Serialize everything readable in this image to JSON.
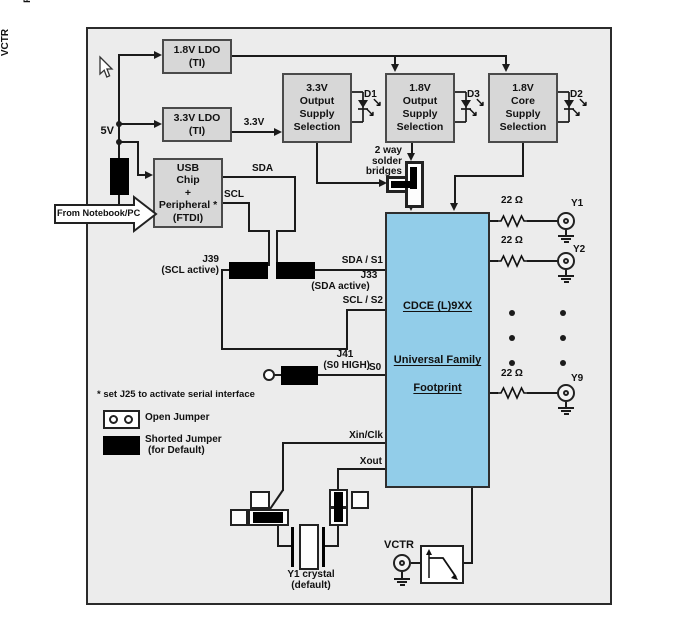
{
  "colors": {
    "ln": "#1b1b1b",
    "panel": "#ececec",
    "bf": "#d7d7d7",
    "bb": "#4a4a4a",
    "chip": "#92cde9"
  },
  "icons": {
    "led_arrow": "↘"
  },
  "power": {
    "v5": "5V",
    "ldo18": {
      "l1": "1.8V LDO",
      "l2": "(TI)"
    },
    "ldo33": {
      "l1": "3.3V LDO",
      "l2": "(TI)"
    },
    "rail33": "3.3V",
    "sel33": {
      "l1": "3.3V",
      "l2": "Output",
      "l3": "Supply",
      "l4": "Selection"
    },
    "sel18out": {
      "l1": "1.8V",
      "l2": "Output",
      "l3": "Supply",
      "l4": "Selection"
    },
    "sel18core": {
      "l1": "1.8V",
      "l2": "Core",
      "l3": "Supply",
      "l4": "Selection"
    },
    "d1": "D1",
    "d3": "D3",
    "d2": "D2",
    "bridge": {
      "l1": "2 way",
      "l2": "solder",
      "l3": "bridges"
    }
  },
  "usb": {
    "from_pc": "From Notebook/PC",
    "j23": {
      "l1": "J23",
      "l2": "(USB Power)"
    },
    "chip": {
      "l1": "USB",
      "l2": "Chip",
      "l3": "+",
      "l4": "Peripheral *",
      "l5": "(FTDI)"
    },
    "sda": "SDA",
    "scl": "SCL"
  },
  "serial": {
    "j39": {
      "l1": "J39",
      "l2": "(SCL active)"
    },
    "j33": {
      "l1": "J33",
      "l2": "(SDA active)"
    },
    "sda_s1": "SDA / S1",
    "scl_s2": "SCL / S2",
    "j41": {
      "l1": "J41",
      "l2": "(S0 HIGH)"
    },
    "s0": "S0",
    "v18": "1.8V",
    "footnote": "* set J25 to activate serial interface"
  },
  "legend": {
    "open": "Open Jumper",
    "shorted": {
      "l1": "Shorted Jumper",
      "l2": "(for Default)"
    }
  },
  "chip": {
    "name": "CDCE (L)9XX",
    "family": "Universal Family",
    "footprint": "Footprint"
  },
  "outputs": {
    "r": "22 Ω",
    "y1": "Y1",
    "y2": "Y2",
    "y9": "Y9",
    "caption1": "Series terminated outputs",
    "caption2": "with option for AC coupling"
  },
  "osc": {
    "xin": "Xin/Clk",
    "xout": "Xout",
    "crystal": {
      "l1": "Y1 crystal",
      "l2": "(default)"
    }
  },
  "vctr": {
    "pin": "VCTR",
    "conn": "VCTR"
  }
}
